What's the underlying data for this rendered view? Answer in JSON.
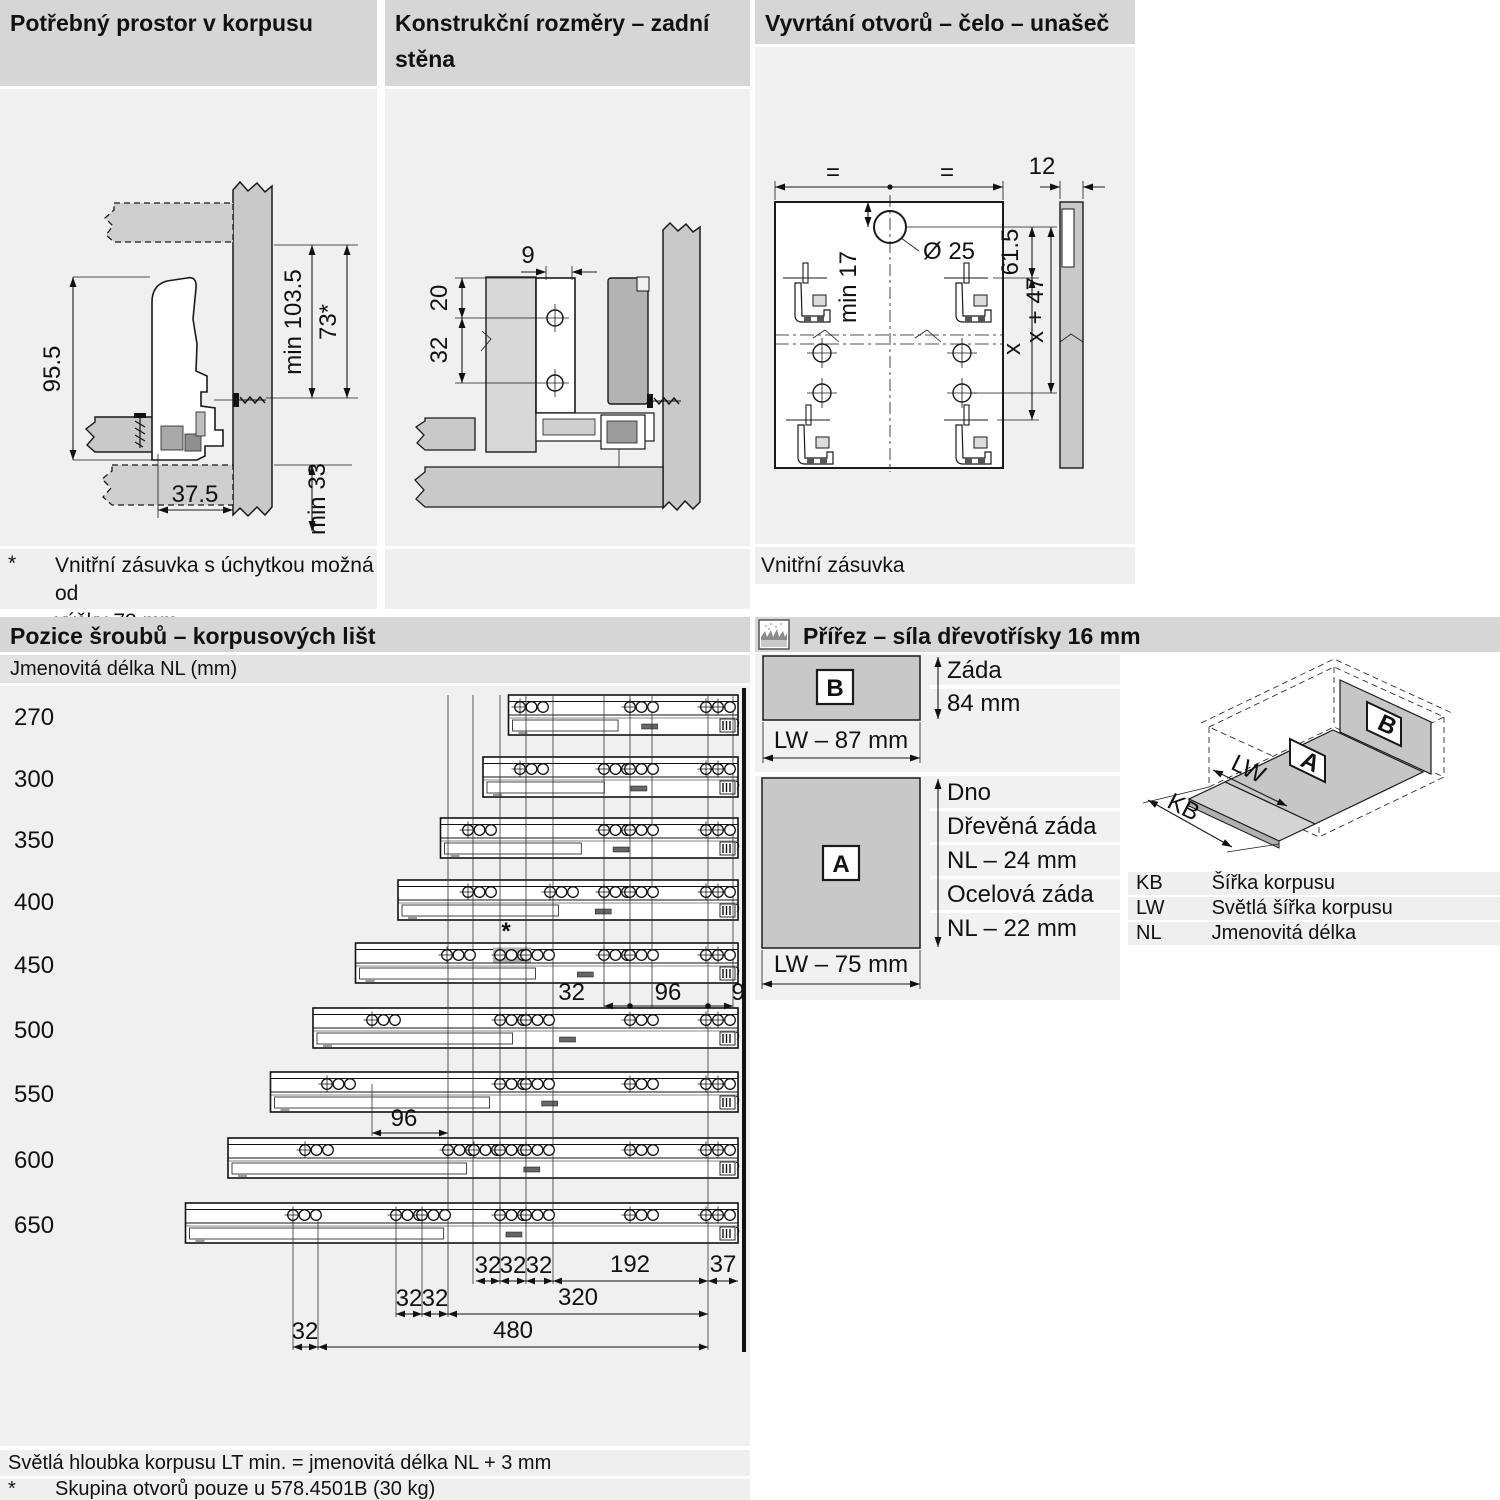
{
  "panels": {
    "p1": {
      "title": "Potřebný prostor v korpusu",
      "dims": {
        "height_side": "95.5",
        "min_height": "min 103.5",
        "height_alt": "73*",
        "min_bottom": "min 33",
        "depth_front": "37.5"
      },
      "footnote_marker": "*",
      "footnote_line1": "Vnitřní zásuvka s úchytkou možná od",
      "footnote_line2": "výšky 73 mm"
    },
    "p2": {
      "title_line1": "Konstrukční rozměry – zadní",
      "title_line2": "stěna",
      "dims": {
        "top": "9",
        "upper": "20",
        "lower": "32"
      }
    },
    "p3": {
      "title": "Vyvrtání otvorů – čelo – unašeč",
      "dims": {
        "eq_left": "=",
        "eq_right": "=",
        "edge": "12",
        "min_top": "min 17",
        "hole_dia": "Ø 25",
        "to_hook": "61.5",
        "x": "x",
        "x47": "x + 47"
      },
      "caption": "Vnitřní zásuvka"
    },
    "p4": {
      "title": "Pozice šroubů – korpusových lišt",
      "subtitle": "Jmenovitá délka NL (mm)",
      "star": "*",
      "rails": [
        {
          "nl": 270,
          "holes": [
            520,
            630
          ]
        },
        {
          "nl": 300,
          "holes": [
            520,
            604,
            630
          ]
        },
        {
          "nl": 350,
          "holes": [
            468,
            604,
            630
          ]
        },
        {
          "nl": 400,
          "holes": [
            468,
            550,
            604,
            630
          ]
        },
        {
          "nl": 450,
          "holes": [
            447,
            500,
            526,
            604,
            630
          ],
          "shaded_hole": 500
        },
        {
          "nl": 500,
          "holes": [
            372,
            500,
            526,
            630
          ]
        },
        {
          "nl": 550,
          "holes": [
            327,
            500,
            526,
            630
          ]
        },
        {
          "nl": 600,
          "holes": [
            305,
            448,
            474,
            500,
            526,
            630
          ]
        },
        {
          "nl": 650,
          "holes": [
            293,
            396,
            422,
            500,
            526,
            630
          ]
        }
      ],
      "dims_mid": [
        "32",
        "96",
        "9"
      ],
      "dim_96": "96",
      "dims_row1": [
        "32",
        "32",
        "32",
        "192",
        "37"
      ],
      "dims_row2": [
        "32",
        "32",
        "320"
      ],
      "dims_row3": [
        "32",
        "480"
      ],
      "footer_line1": "Světlá hloubka korpusu LT min. = jmenovitá délka NL + 3 mm",
      "footer_marker": "*",
      "footer_line2": "Skupina otvorů pouze u 578.4501B (30 kg)"
    },
    "p5": {
      "title": "Přířez – síla dřevotřísky 16 mm",
      "panel_b": {
        "label": "B",
        "right_line1": "Záda",
        "right_line2": "84 mm",
        "width_label": "LW – 87 mm"
      },
      "panel_a": {
        "label": "A",
        "right_lines": [
          "Dno",
          "Dřevěná záda",
          "NL – 24 mm",
          "Ocelová záda",
          "NL – 22 mm"
        ],
        "width_label": "LW – 75 mm"
      },
      "iso": {
        "label_a": "A",
        "label_b": "B",
        "arrow_lw": "LW",
        "arrow_kb": "KB"
      },
      "legend": [
        {
          "abbr": "KB",
          "desc": "Šířka korpusu"
        },
        {
          "abbr": "LW",
          "desc": "Světlá šířka korpusu"
        },
        {
          "abbr": "NL",
          "desc": "Jmenovitá délka"
        }
      ]
    }
  },
  "colors": {
    "header_bar": "#d6d6d6",
    "panel_bg": "#f0f0f0",
    "wood_fill": "#c9c9c9",
    "shaded_hole_group": "#b1b1b1"
  }
}
